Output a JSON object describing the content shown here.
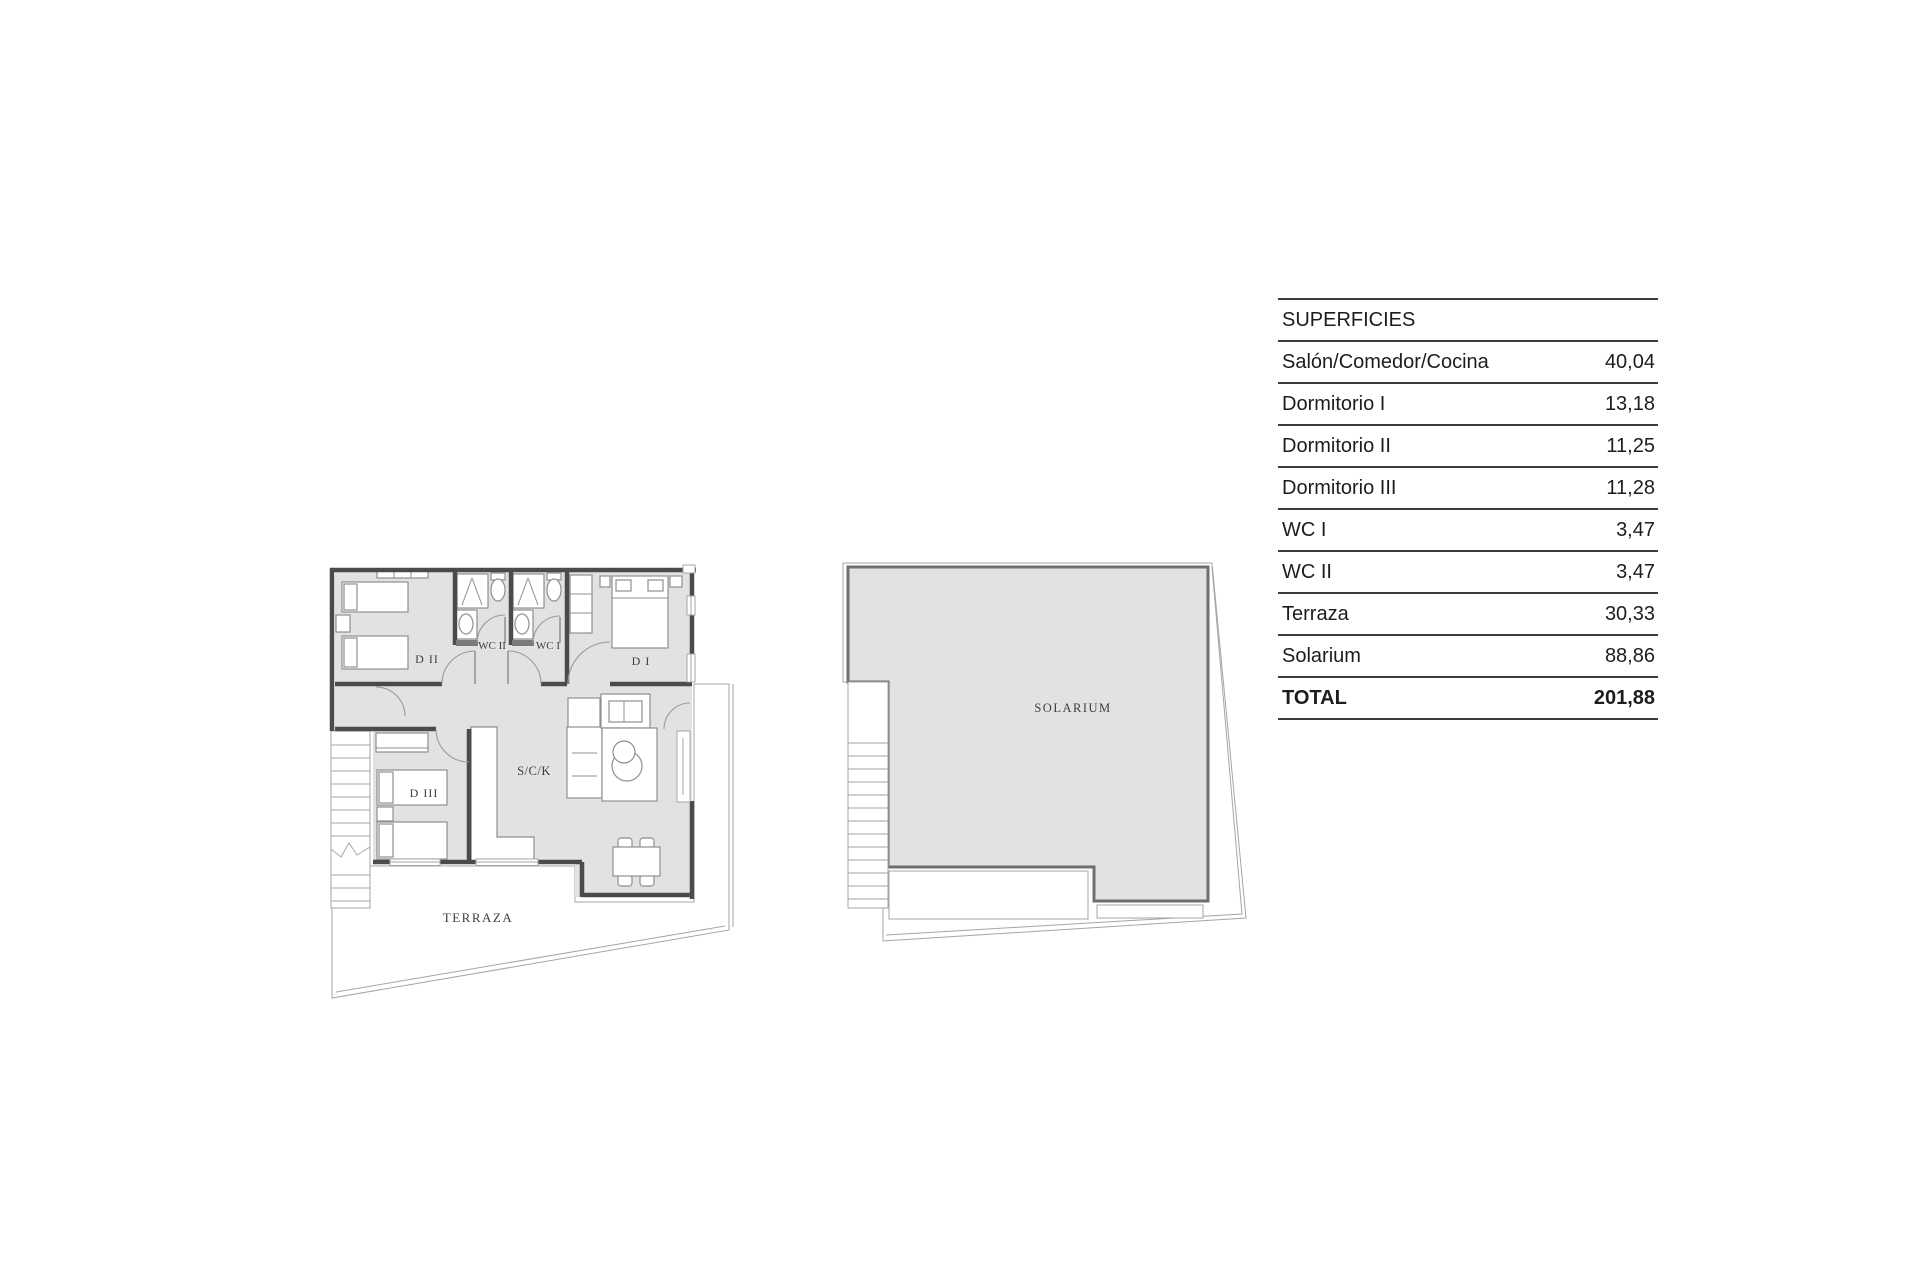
{
  "plan": {
    "room_labels": {
      "d2": "D II",
      "wc2": "WC II",
      "wc1": "WC I",
      "d1": "D I",
      "d3": "D III",
      "sck": "S/C/K",
      "terrace": "TERRAZA"
    }
  },
  "solarium_plan": {
    "label": "SOLARIUM"
  },
  "table": {
    "header": "SUPERFICIES",
    "rows": [
      {
        "label": "Salón/Comedor/Cocina",
        "value": "40,04"
      },
      {
        "label": "Dormitorio I",
        "value": "13,18"
      },
      {
        "label": "Dormitorio II",
        "value": "11,25"
      },
      {
        "label": "Dormitorio III",
        "value": "11,28"
      },
      {
        "label": "WC I",
        "value": "3,47"
      },
      {
        "label": "WC II",
        "value": "3,47"
      },
      {
        "label": "Terraza",
        "value": "30,33"
      },
      {
        "label": "Solarium",
        "value": "88,86"
      }
    ],
    "total": {
      "label": "TOTAL",
      "value": "201,88"
    }
  },
  "colors": {
    "wall": "#4b4b4b",
    "room_fill": "#e2e2e2",
    "table_line": "#3b3b3b",
    "table_text": "#1d1d1d",
    "plan_text": "#3e3e3e"
  }
}
